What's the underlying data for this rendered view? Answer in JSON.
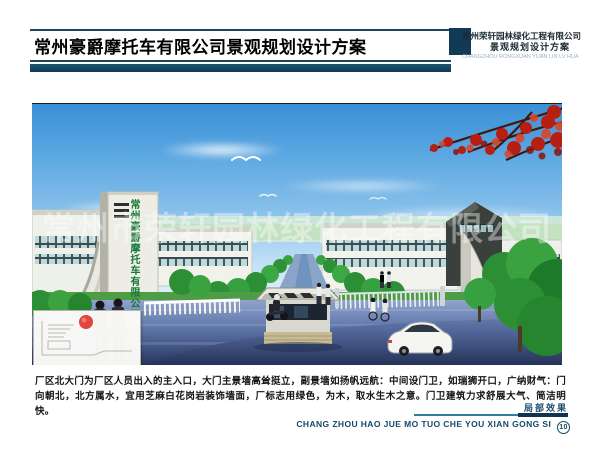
{
  "header": {
    "title": "常州豪爵摩托车有限公司景观规划设计方案",
    "company": "常州荣轩园林绿化工程有限公司",
    "subtitle": "景观规划设计方案",
    "pinyin": "CHANGZHOU RONGXUAN YUAN LIN LV HUA"
  },
  "artwork": {
    "pylon_text": "常州豪爵摩托车有限公司",
    "watermark": "常州市荣轩园林绿化工程有限公司"
  },
  "description": {
    "text": "厂区北大门为厂区人员出入的主入口，大门主景墙高耸挺立，副景墙如扬帆远航：中间设门卫，如瑞狮开口，广纳财气：门向朝北，北方属水，宜用芝麻白花岗岩装饰墙面，厂标志用绿色，为木，取水生木之意。门卫建筑力求舒展大气、简洁明快。"
  },
  "footer": {
    "caption": "局部效果",
    "pinyin": "CHANG ZHOU HAO JUE MO TUO CHE YOU XIAN GONG SI",
    "page_number": "10"
  },
  "colors": {
    "accent_navy": "#12334d",
    "accent_teal": "#2e7fa8",
    "pylon_green": "#157a38",
    "marker_red": "#d9332a",
    "sky_blue": "#3b90d6"
  }
}
